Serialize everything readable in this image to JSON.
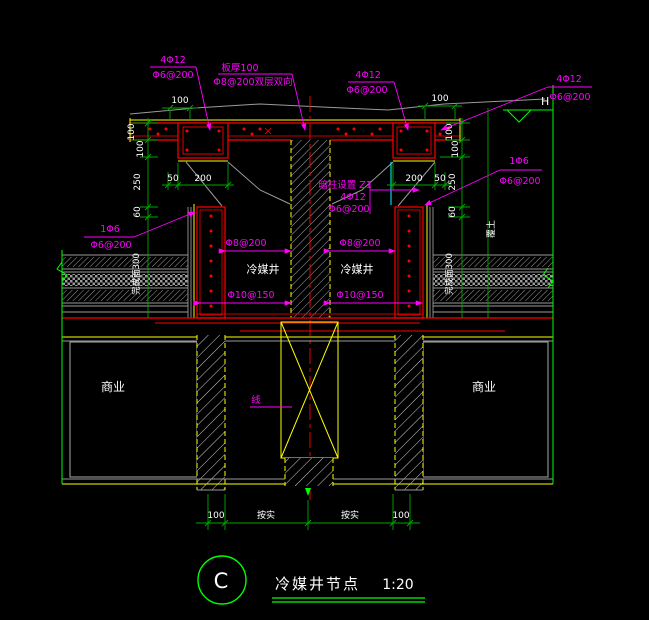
{
  "title": {
    "letter": "C",
    "name": "冷媒井节点",
    "scale": "1:20"
  },
  "texts": {
    "shaft_left": "冷媒井",
    "shaft_right": "冷媒井",
    "room_left": "商业",
    "room_right": "商业",
    "upturn_left": "完成面300",
    "upturn_right": "完成面300",
    "soil": "覆土",
    "level": "H"
  },
  "labels": {
    "top_left": {
      "l1": "4Φ12",
      "l2": "Φ6@200"
    },
    "slab_note": {
      "l1": "板厚100",
      "l2": "Φ8@200双层双向"
    },
    "top_mid": {
      "l1": "4Φ12",
      "l2": "Φ6@200"
    },
    "top_right": {
      "l1": "4Φ12",
      "l2": "Φ6@200"
    },
    "tie_left": {
      "l1": "1Φ6",
      "l2": "Φ6@200"
    },
    "tie_right": {
      "l1": "1Φ6",
      "l2": "Φ6@200"
    },
    "column_note": {
      "l1": "暗柱设置 Z1",
      "l2": "4Φ12",
      "l3": "Φ6@200"
    },
    "wall_h_left": "Φ8@200",
    "wall_h_right": "Φ8@200",
    "wall_v_left": "Φ10@150",
    "wall_v_right": "Φ10@150",
    "center_note": "线"
  },
  "dims": {
    "top_left": "100",
    "top_right": "100",
    "left_chain": [
      "100",
      "100",
      "250",
      "60"
    ],
    "right_chain": [
      "100",
      "100",
      "250",
      "60"
    ],
    "beam_left": [
      "50",
      "200"
    ],
    "beam_right": [
      "200",
      "50"
    ],
    "bottom": [
      "100",
      "按实",
      "按实",
      "100"
    ]
  },
  "colors": {
    "background": "#000000",
    "structure_red": "#ff0000",
    "finish_yellow": "#ffff00",
    "rebar_magenta": "#ff00ff",
    "dim_green": "#00a800",
    "boundary_green": "#00ff00",
    "layer_gray": "#9a9a9a",
    "text_white": "#ffffff",
    "membrane_cyan": "#00ffff"
  }
}
